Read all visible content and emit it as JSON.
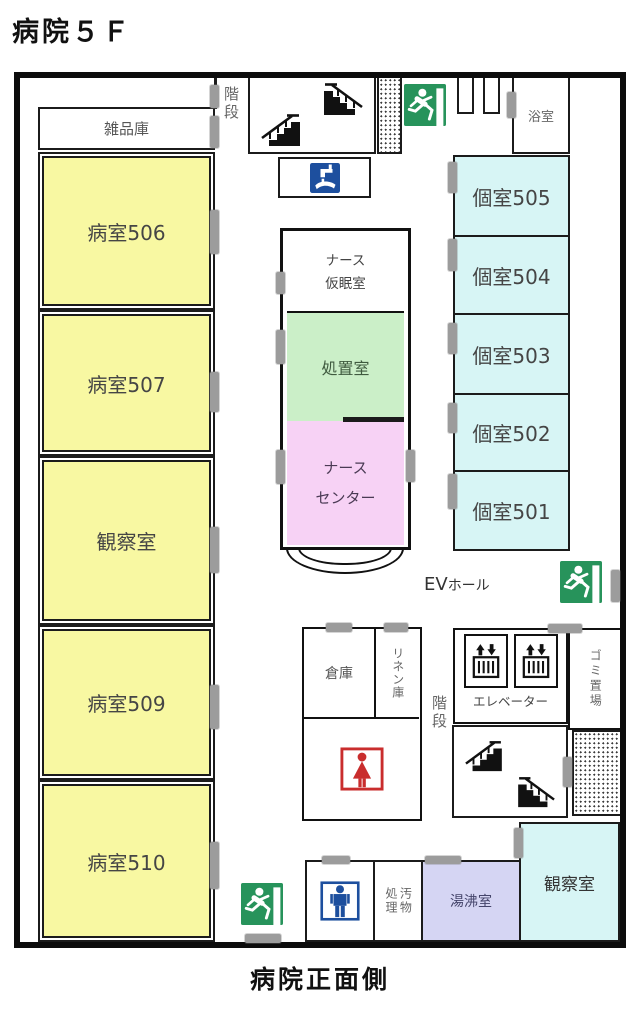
{
  "title": "病院５Ｆ",
  "footer": "病院正面側",
  "left_wing": {
    "storage": "雑品庫",
    "ward506": "病室506",
    "ward507": "病室507",
    "observation": "観察室",
    "ward509": "病室509",
    "ward510": "病室510"
  },
  "top_area": {
    "stairs_label": "階段",
    "bath": "浴室"
  },
  "nurse_block": {
    "rest_room": "ナース\n仮眠室",
    "treatment_room": "処置室",
    "nurse_station": "ナース\nセンター"
  },
  "right_wing": {
    "room505": "個室505",
    "room504": "個室504",
    "room503": "個室503",
    "room502": "個室502",
    "room501": "個室501"
  },
  "ev_area": {
    "hall_en": "EV",
    "hall_jp": "ホール",
    "elevator_label": "エレベーター",
    "garbage": "ゴミ置場",
    "stairs_label": "階段"
  },
  "service_area": {
    "warehouse": "倉庫",
    "linen": "リネン庫",
    "waste": "汚物\n処理",
    "hot_water": "湯沸室",
    "observation2": "観察室"
  },
  "icons": {
    "exit": "emergency-exit-running-man",
    "stairs_up": "stairs-ascending",
    "stairs_down": "stairs-descending",
    "elevator": "elevator-up-down-arrows",
    "handwash": "hand-wash-station",
    "womens_toilet": "womens-toilet-figure",
    "mens_toilet": "mens-toilet-figure"
  },
  "colors": {
    "ward_yellow": "#F8F8A2",
    "private_room_cyan": "#D7F5F5",
    "treatment_green": "#CBEFC8",
    "nurse_station_pink": "#F7D2F5",
    "hot_water_lavender": "#D5D5F3",
    "exit_green": "#27935B",
    "toilet_blue": "#1D4F9E",
    "toilet_red": "#C92D2D",
    "door_gray": "#9C9C9C"
  }
}
